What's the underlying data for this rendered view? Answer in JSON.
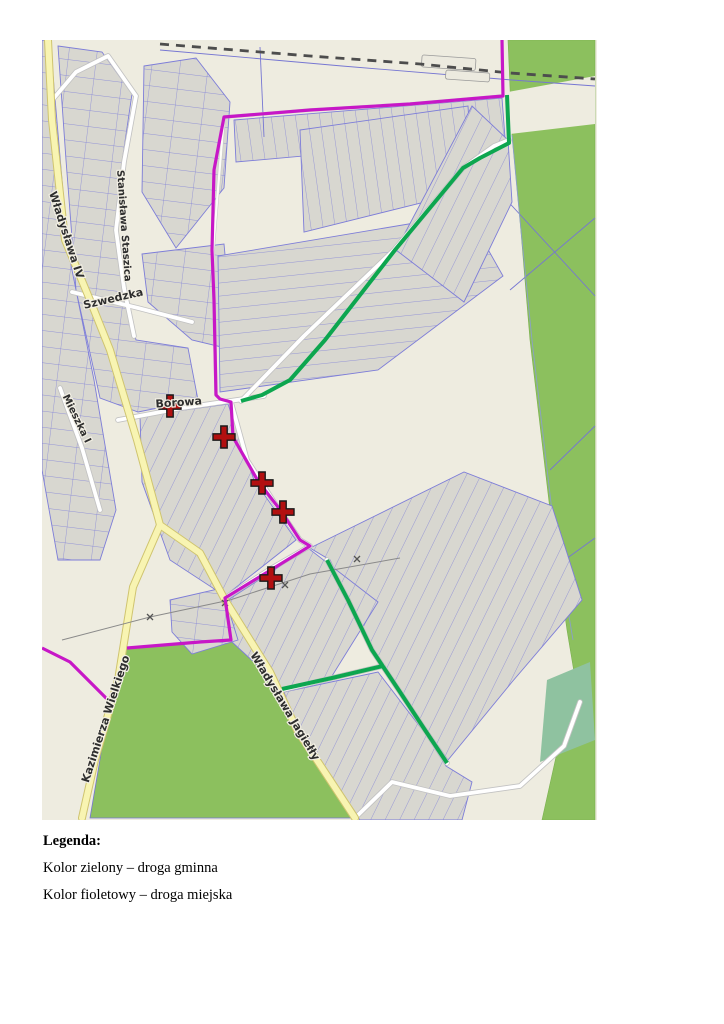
{
  "legend": {
    "title": "Legenda:",
    "items": [
      {
        "label": "Kolor zielony – droga gminna",
        "color": "#0da64f"
      },
      {
        "label": "Kolor fioletowy – droga miejska",
        "color": "#c717c7"
      }
    ]
  },
  "map": {
    "colors": {
      "background": "#eeece0",
      "forest_green": "#8cc05e",
      "parcel_gray": "#d8d7d0",
      "parcel_line_blue": "#7676d2",
      "route_green": "#0da64f",
      "route_magenta": "#c717c7",
      "marker_red": "#b21010"
    },
    "street_labels": [
      {
        "text": "Władysława IV",
        "x": 21,
        "y": 196,
        "rotate": 72,
        "size": 11
      },
      {
        "text": "Stanisława Staszica",
        "x": 79,
        "y": 186,
        "rotate": 86,
        "size": 10
      },
      {
        "text": "Szwedzka",
        "x": 72,
        "y": 262,
        "rotate": -13,
        "size": 11
      },
      {
        "text": "Mieszka I",
        "x": 32,
        "y": 380,
        "rotate": 64,
        "size": 10
      },
      {
        "text": "Borowa",
        "x": 137,
        "y": 366,
        "rotate": -4,
        "size": 11
      },
      {
        "text": "Kazimierza Wielkiego",
        "x": 67,
        "y": 680,
        "rotate": -72,
        "size": 11
      },
      {
        "text": "Władysława Jagiełły",
        "x": 240,
        "y": 668,
        "rotate": 59,
        "size": 11
      }
    ],
    "routes": {
      "droga_gminna": {
        "label": "droga gminna",
        "color": "#0da64f",
        "width": 4,
        "polylines": [
          [
            [
              465,
              55
            ],
            [
              467,
              103
            ],
            [
              438,
              118
            ],
            [
              421,
              128
            ],
            [
              353,
              210
            ],
            [
              283,
              300
            ],
            [
              248,
              340
            ],
            [
              220,
              355
            ],
            [
              199,
              361
            ]
          ],
          [
            [
              285,
              520
            ],
            [
              306,
              560
            ],
            [
              330,
              610
            ],
            [
              358,
              652
            ],
            [
              383,
              690
            ],
            [
              405,
              723
            ]
          ],
          [
            [
              240,
              649
            ],
            [
              290,
              638
            ],
            [
              341,
              626
            ]
          ]
        ]
      },
      "droga_miejska": {
        "label": "droga miejska",
        "color": "#c717c7",
        "width": 3.2,
        "polylines": [
          [
            [
              460,
              0
            ],
            [
              461,
              56
            ],
            [
              368,
              64
            ],
            [
              268,
              70
            ],
            [
              182,
              77
            ],
            [
              172,
              130
            ],
            [
              170,
              210
            ],
            [
              172,
              260
            ],
            [
              174,
              355
            ],
            [
              178,
              359
            ],
            [
              189,
              362
            ],
            [
              191,
              397
            ],
            [
              216,
              441
            ],
            [
              239,
              471
            ],
            [
              258,
              500
            ],
            [
              268,
              506
            ],
            [
              183,
              558
            ],
            [
              189,
              600
            ],
            [
              158,
              602
            ],
            [
              85,
              608
            ]
          ],
          [
            [
              0,
              608
            ],
            [
              28,
              622
            ],
            [
              65,
              659
            ]
          ]
        ]
      }
    },
    "markers": {
      "shape": "red-cross",
      "color": "#b21010",
      "positions": [
        [
          128,
          366
        ],
        [
          182,
          397
        ],
        [
          220,
          443
        ],
        [
          241,
          472
        ],
        [
          229,
          538
        ]
      ]
    }
  }
}
